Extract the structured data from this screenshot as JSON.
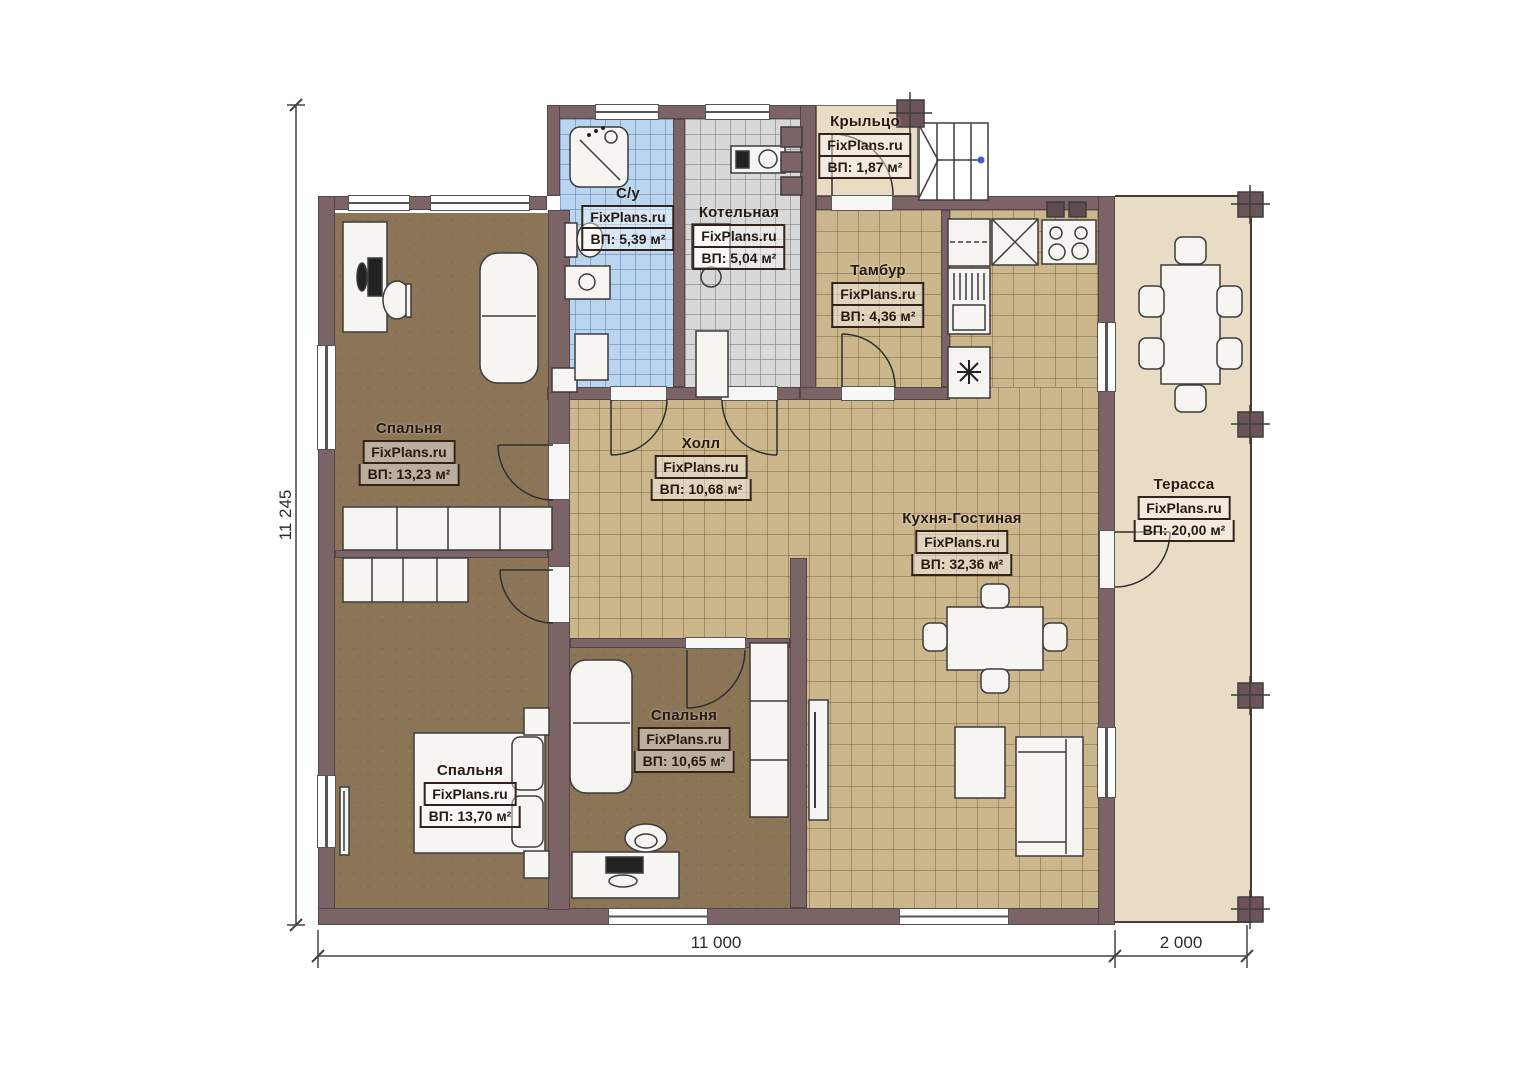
{
  "plan": {
    "brand": "FixPlans.ru",
    "rooms": {
      "porch": {
        "name": "Крыльцо",
        "area": "ВП: 1,87 м²"
      },
      "bathroom": {
        "name": "С/у",
        "area": "ВП: 5,39 м²"
      },
      "boiler": {
        "name": "Котельная",
        "area": "ВП: 5,04 м²"
      },
      "vestibule": {
        "name": "Тамбур",
        "area": "ВП: 4,36 м²"
      },
      "bedroom_top": {
        "name": "Спальня",
        "area": "ВП: 13,23 м²"
      },
      "hall": {
        "name": "Холл",
        "area": "ВП: 10,68 м²"
      },
      "kitchen_living": {
        "name": "Кухня-Гостиная",
        "area": "ВП: 32,36 м²"
      },
      "terrace": {
        "name": "Терасса",
        "area": "ВП: 20,00 м²"
      },
      "bedroom_mid": {
        "name": "Спальня",
        "area": "ВП: 10,65 м²"
      },
      "bedroom_bottom": {
        "name": "Спальня",
        "area": "ВП: 13,70 м²"
      }
    },
    "dimensions": {
      "height": "11 245",
      "width_main": "11 000",
      "width_terrace": "2 000"
    },
    "colors": {
      "wall": "#7b6366",
      "wood_floor": "#8c7457",
      "tile_tan": "#ccb68c",
      "tile_blue": "#b9d5ef",
      "tile_gray": "#d8d8d8",
      "outdoor": "#e8dcc4"
    }
  }
}
